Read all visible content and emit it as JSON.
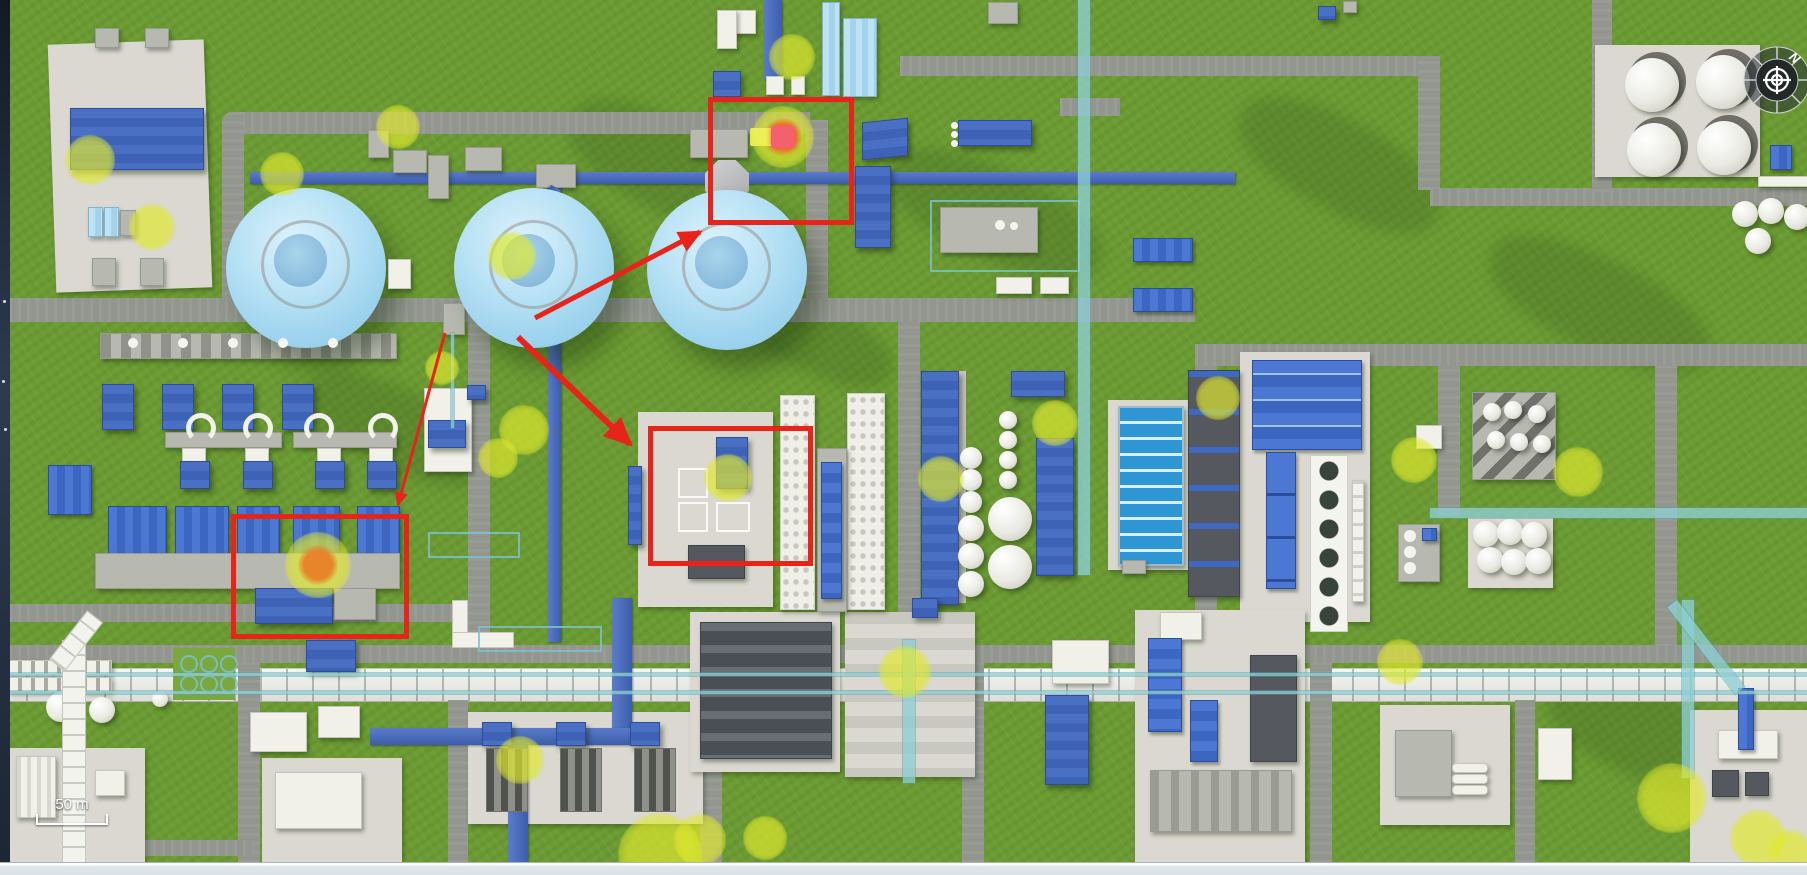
{
  "view": {
    "compass_label": "N",
    "scale_label": "50 m"
  },
  "colors": {
    "annotation_red": "#e8231a",
    "highlight_yellow": "#dde42c",
    "hotspot_orange": "#e8872c",
    "hotspot_core_pink": "#f4616e",
    "grass_green": "#6b9b32",
    "sphere_blue": "#a8d8ef",
    "building_blue": "#3e62b5"
  },
  "annotations": {
    "boxes": [
      {
        "id": "alert-area-1",
        "x": 708,
        "y": 97,
        "w": 136,
        "h": 118,
        "stroke": 5
      },
      {
        "id": "alert-area-2",
        "x": 648,
        "y": 426,
        "w": 155,
        "h": 130,
        "stroke": 5
      },
      {
        "id": "alert-area-3",
        "x": 231,
        "y": 514,
        "w": 168,
        "h": 115,
        "stroke": 5
      }
    ],
    "arrows": [
      {
        "id": "arrow-1",
        "x1": 535,
        "y1": 318,
        "x2": 700,
        "y2": 232,
        "w": 5
      },
      {
        "id": "arrow-2",
        "x1": 518,
        "y1": 337,
        "x2": 630,
        "y2": 444,
        "w": 6
      },
      {
        "id": "arrow-3",
        "x1": 445,
        "y1": 333,
        "x2": 398,
        "y2": 505,
        "w": 3
      }
    ]
  },
  "markers": {
    "highlights": [
      {
        "x": 90,
        "y": 160,
        "r": 25
      },
      {
        "x": 152,
        "y": 227,
        "r": 23
      },
      {
        "x": 282,
        "y": 174,
        "r": 22
      },
      {
        "x": 398,
        "y": 127,
        "r": 22
      },
      {
        "x": 512,
        "y": 256,
        "r": 24
      },
      {
        "x": 442,
        "y": 368,
        "r": 17
      },
      {
        "x": 524,
        "y": 430,
        "r": 25
      },
      {
        "x": 498,
        "y": 458,
        "r": 20
      },
      {
        "x": 728,
        "y": 478,
        "r": 24
      },
      {
        "x": 792,
        "y": 57,
        "r": 23
      },
      {
        "x": 941,
        "y": 479,
        "r": 23
      },
      {
        "x": 1055,
        "y": 423,
        "r": 23
      },
      {
        "x": 1218,
        "y": 398,
        "r": 22
      },
      {
        "x": 1414,
        "y": 460,
        "r": 23
      },
      {
        "x": 1578,
        "y": 472,
        "r": 25
      },
      {
        "x": 520,
        "y": 760,
        "r": 24
      },
      {
        "x": 660,
        "y": 855,
        "r": 42
      },
      {
        "x": 700,
        "y": 840,
        "r": 26
      },
      {
        "x": 765,
        "y": 838,
        "r": 22
      },
      {
        "x": 905,
        "y": 672,
        "r": 26
      },
      {
        "x": 1400,
        "y": 662,
        "r": 23
      },
      {
        "x": 1672,
        "y": 798,
        "r": 35
      },
      {
        "x": 1758,
        "y": 838,
        "r": 28
      },
      {
        "x": 1790,
        "y": 852,
        "r": 22
      }
    ],
    "hotspots": [
      {
        "x": 783,
        "y": 137,
        "r": 31,
        "core": "bar"
      },
      {
        "x": 318,
        "y": 565,
        "r": 33,
        "core": "round"
      }
    ]
  }
}
